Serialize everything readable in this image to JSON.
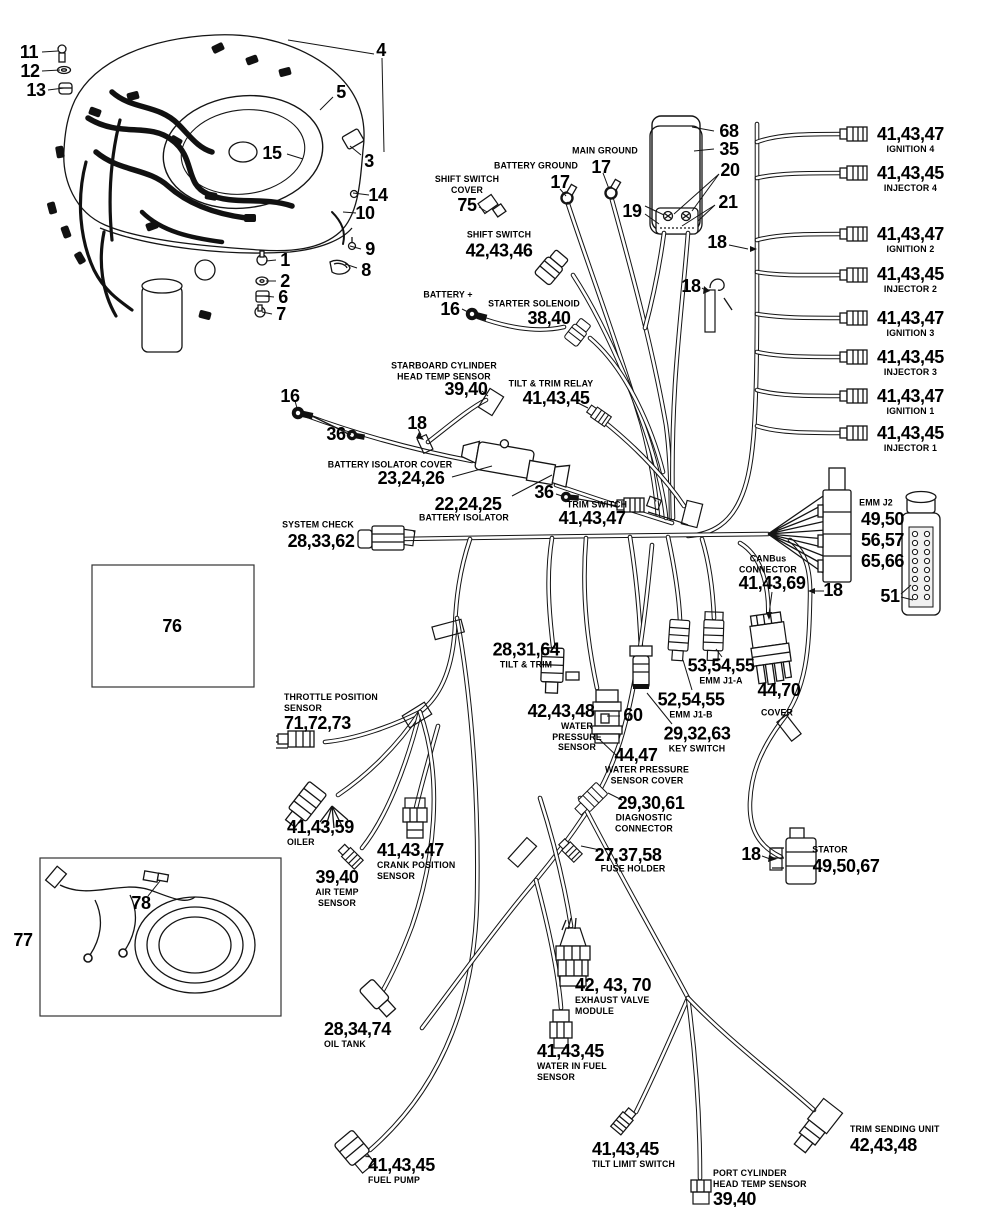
{
  "parts": {
    "shift_switch_cover": {
      "name": "SHIFT SWITCH\nCOVER",
      "num": "75"
    },
    "shift_switch": {
      "name": "SHIFT SWITCH",
      "num": "42,43,46"
    },
    "battery_ground": {
      "name": "BATTERY GROUND",
      "num": "17"
    },
    "main_ground": {
      "name": "MAIN GROUND",
      "num": "17"
    },
    "battery_plus": {
      "name": "BATTERY +",
      "num": "16"
    },
    "starter_solenoid": {
      "name": "STARTER SOLENOID",
      "num": "38,40"
    },
    "ignition4": {
      "num": "41,43,47",
      "name": "IGNITION 4"
    },
    "injector4": {
      "num": "41,43,45",
      "name": "INJECTOR 4"
    },
    "ignition2": {
      "num": "41,43,47",
      "name": "IGNITION 2"
    },
    "injector2": {
      "num": "41,43,45",
      "name": "INJECTOR 2"
    },
    "ignition3": {
      "num": "41,43,47",
      "name": "IGNITION 3"
    },
    "injector3": {
      "num": "41,43,45",
      "name": "INJECTOR 3"
    },
    "ignition1": {
      "num": "41,43,47",
      "name": "IGNITION 1"
    },
    "injector1": {
      "num": "41,43,45",
      "name": "INJECTOR 1"
    },
    "starboard_head_temp": {
      "name": "STARBOARD CYLINDER\nHEAD TEMP SENSOR",
      "num": "39,40"
    },
    "tilt_trim_relay": {
      "name": "TILT & TRIM RELAY",
      "num": "41,43,45"
    },
    "battery_isolator_cover": {
      "name": "BATTERY ISOLATOR COVER",
      "num": "23,24,26"
    },
    "battery_isolator": {
      "num": "22,24,25",
      "name": "BATTERY ISOLATOR"
    },
    "trim_switch": {
      "name": "TRIM SWITCH",
      "num": "41,43,47"
    },
    "system_check": {
      "name": "SYSTEM CHECK",
      "num": "28,33,62"
    },
    "emm_j2": {
      "name": "EMM J2",
      "num": "49,50\n56,57\n65,66"
    },
    "canbus": {
      "name": "CANBus\nCONNECTOR",
      "num": "41,43,69"
    },
    "emm_j1a": {
      "num": "53,54,55",
      "name": "EMM J1-A"
    },
    "emm_j1b": {
      "num": "52,54,55",
      "name": "EMM J1-B"
    },
    "key_switch": {
      "num": "29,32,63",
      "name": "KEY SWITCH"
    },
    "cover": {
      "num": "44,70",
      "name": "COVER"
    },
    "tilt_trim": {
      "num": "28,31,64",
      "name": "TILT & TRIM"
    },
    "water_pressure_sensor": {
      "num": "42,43,48",
      "name": "WATER\nPRESSURE\nSENSOR"
    },
    "water_pressure_cover": {
      "num": "44,47",
      "name": "WATER PRESSURE\nSENSOR COVER"
    },
    "diagnostic": {
      "num": "29,30,61",
      "name": "DIAGNOSTIC\nCONNECTOR"
    },
    "fuse_holder": {
      "num": "27,37,58",
      "name": "FUSE HOLDER"
    },
    "stator": {
      "name": "STATOR",
      "num": "49,50,67"
    },
    "throttle_position": {
      "name": "THROTTLE POSITION\nSENSOR",
      "num": "71,72,73"
    },
    "oiler": {
      "num": "41,43,59",
      "name": "OILER"
    },
    "crank_position": {
      "num": "41,43,47",
      "name": "CRANK POSITION\nSENSOR"
    },
    "air_temp": {
      "num": "39,40",
      "name": "AIR TEMP\nSENSOR"
    },
    "oil_tank": {
      "num": "28,34,74",
      "name": "OIL TANK"
    },
    "fuel_pump": {
      "num": "41,43,45",
      "name": "FUEL PUMP"
    },
    "water_in_fuel": {
      "num": "41,43,45",
      "name": "WATER IN FUEL\nSENSOR"
    },
    "exhaust_valve_module": {
      "num": "42, 43, 70",
      "name": "EXHAUST VALVE\nMODULE"
    },
    "tilt_limit": {
      "num": "41,43,45",
      "name": "TILT LIMIT SWITCH"
    },
    "port_head_temp": {
      "name": "PORT CYLINDER\nHEAD TEMP SENSOR",
      "num": "39,40"
    },
    "trim_sending": {
      "name": "TRIM SENDING UNIT",
      "num": "42,43,48"
    }
  },
  "callouts": {
    "c1": "1",
    "c2": "2",
    "c3": "3",
    "c4": "4",
    "c5": "5",
    "c6": "6",
    "c7": "7",
    "c8": "8",
    "c9": "9",
    "c10": "10",
    "c11": "11",
    "c12": "12",
    "c13": "13",
    "c14": "14",
    "c15": "15",
    "c16_isolator": "16",
    "c18_trunk": "18",
    "c18_clip": "18",
    "c18_clamp": "18",
    "c18_emm": "18",
    "c18_stator": "18",
    "c19": "19",
    "c20": "20",
    "c21": "21",
    "c35": "35",
    "c36_a": "36",
    "c36_b": "36",
    "c51": "51",
    "c60": "60",
    "c68": "68",
    "c76": "76",
    "c77": "77",
    "c78": "78"
  }
}
